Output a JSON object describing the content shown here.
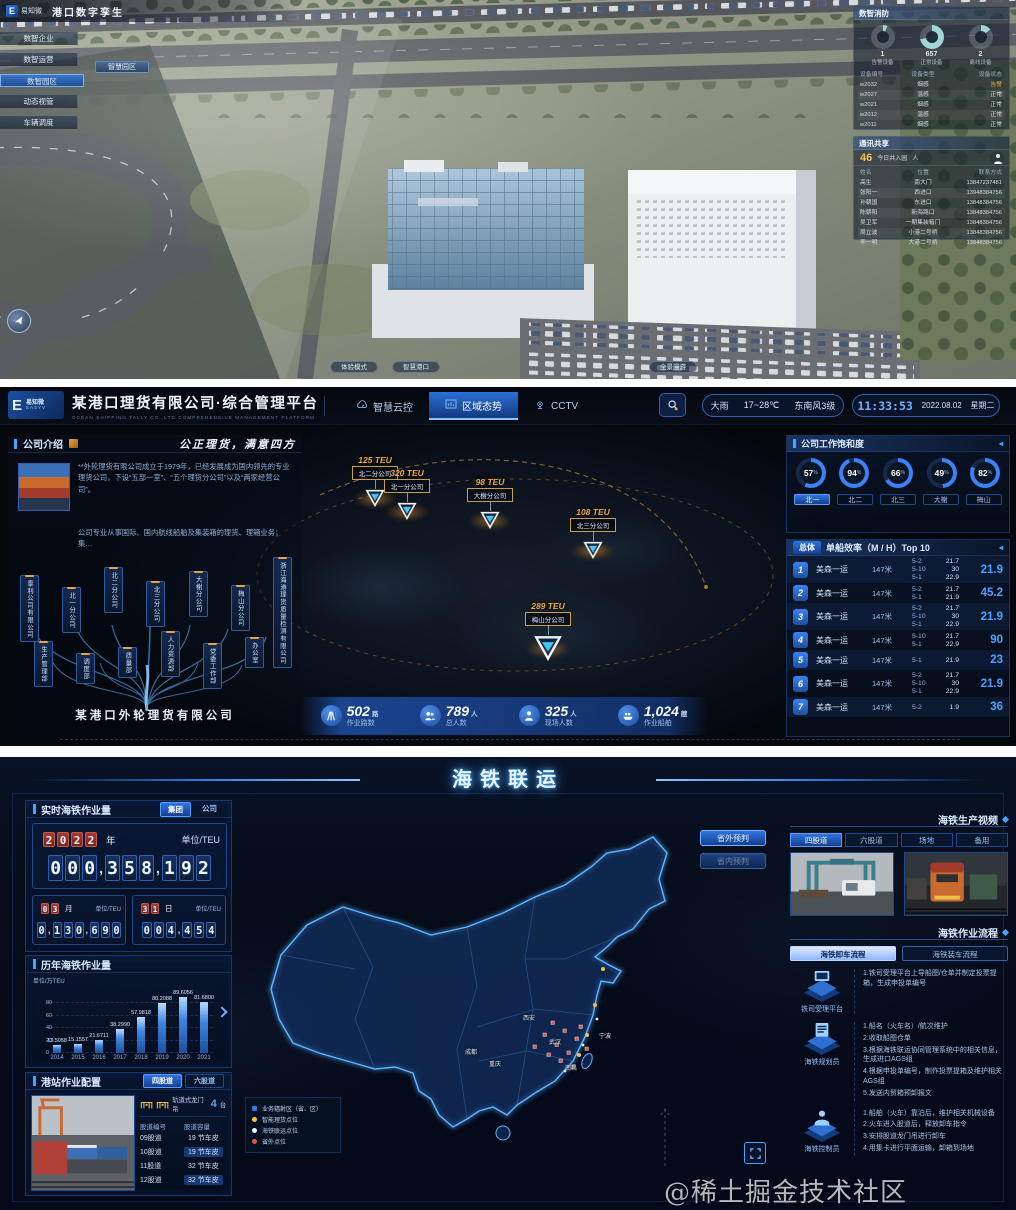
{
  "s1": {
    "logo": "易知微",
    "title": "港口数字孪生",
    "menu": [
      "数智企业",
      "数智运营",
      "数智园区",
      "动态视管",
      "车辆调度"
    ],
    "submenu": "智慧园区",
    "bottom_buttons": [
      "体验模式",
      "智慧港口",
      "全景漫游"
    ],
    "devices": {
      "title": "数智消防",
      "donuts": [
        {
          "value": "1",
          "label": "告警设备",
          "pct": 6
        },
        {
          "value": "657",
          "label": "正常设备",
          "pct": 72
        },
        {
          "value": "2",
          "label": "离线设备",
          "pct": 14
        }
      ],
      "headers": [
        "设备编号",
        "设备类型",
        "设备状态"
      ],
      "rows": [
        [
          "w2032",
          "烟感",
          "告警"
        ],
        [
          "w2027",
          "温感",
          "正常"
        ],
        [
          "w2021",
          "烟感",
          "正常"
        ],
        [
          "w2012",
          "温感",
          "正常"
        ],
        [
          "w2011",
          "烟感",
          "正常"
        ]
      ]
    },
    "contacts": {
      "title": "通讯共享",
      "today_value": "46",
      "today_label": "今日共入园",
      "today_unit": "人",
      "headers": [
        "姓名",
        "位置",
        "联系方式"
      ],
      "rows": [
        [
          "高生",
          "南大门",
          "13847237481"
        ],
        [
          "张阳一",
          "西进口",
          "13948384756"
        ],
        [
          "孙朝国",
          "东进口",
          "13848384756"
        ],
        [
          "陈朝阳",
          "新海路口",
          "13848384756"
        ],
        [
          "吴卫军",
          "一期集装箱门",
          "13848384756"
        ],
        [
          "周立波",
          "小港二号桥",
          "13848384756"
        ],
        [
          "李一明",
          "大港二号桥",
          "13848384756"
        ]
      ]
    }
  },
  "s2": {
    "logo_text": "易知微",
    "logo_sub": "EASYV",
    "title": "某港口理货有限公司·综合管理平台",
    "subtitle": "OCEAN SHIPPING TALLY CO.,LTD COMPREHENSIVE MANAGEMENT PLATFORM",
    "nav": [
      "智慧云控",
      "区域态势",
      "CCTV"
    ],
    "weather": {
      "cond": "大雨",
      "temp": "17~28℃",
      "wind": "东南风3级"
    },
    "clock": {
      "time": "11:33:53",
      "date": "2022.08.02",
      "week": "星期二"
    },
    "company": {
      "header": "公司介绍",
      "slogan": "公正理货，满意四方",
      "para1": "**外轮理货有限公司成立于1979年，已经发展成为国内领先的专业理货公司，下设“五部一室”、“五个理货分公司”以及“两家经营公司”。",
      "para2": "公司专业从事国际、国内航线船舶及集装箱的理货、理箱业务；集…",
      "org_top": [
        "泰利公司有限公司",
        "北一分公司",
        "北二分公司",
        "北三分公司",
        "大榭分公司",
        "梅山分公司",
        "浙江海港理货质量检测有限公司"
      ],
      "org_bottom": [
        "生产管理部",
        "调度部",
        "质量部",
        "人力资源部",
        "党委工作部",
        "办公室"
      ],
      "root": "某港口外轮理货有限公司"
    },
    "markers": [
      {
        "teu": "125 TEU",
        "name": "北二分公司"
      },
      {
        "teu": "320 TEU",
        "name": "北一分公司"
      },
      {
        "teu": "98 TEU",
        "name": "大榭分公司"
      },
      {
        "teu": "108 TEU",
        "name": "北三分公司"
      },
      {
        "teu": "289 TEU",
        "name": "梅山分公司"
      }
    ],
    "stats": [
      {
        "value": "502",
        "unit": "路",
        "label": "作业路数"
      },
      {
        "value": "789",
        "unit": "人",
        "label": "总人数"
      },
      {
        "value": "325",
        "unit": "人",
        "label": "现场人数"
      },
      {
        "value": "1,024",
        "unit": "艘",
        "label": "作业船舶"
      }
    ],
    "saturation": {
      "header": "公司工作饱和度",
      "gauges": [
        57,
        94,
        66,
        49,
        82
      ],
      "tabs": [
        "北一",
        "北二",
        "北三",
        "大榭",
        "梅山"
      ]
    },
    "top10": {
      "label": "总体",
      "header": "单船效率（M / H）Top 10",
      "rows": [
        {
          "rank": "1",
          "name": "美森一运",
          "len": "147米",
          "subs": [
            [
              "5-2",
              "21.7"
            ],
            [
              "5-10",
              "30"
            ],
            [
              "5-1",
              "22.9"
            ]
          ],
          "total": "21.9"
        },
        {
          "rank": "2",
          "name": "美森一运",
          "len": "147米",
          "subs": [
            [
              "5-2",
              "21.7"
            ],
            [
              "5-1",
              "21.9"
            ]
          ],
          "total": "45.2"
        },
        {
          "rank": "3",
          "name": "美森一运",
          "len": "147米",
          "subs": [
            [
              "5-2",
              "21.7"
            ],
            [
              "5-10",
              "30"
            ],
            [
              "5-1",
              "22.9"
            ]
          ],
          "total": "21.9"
        },
        {
          "rank": "4",
          "name": "美森一运",
          "len": "147米",
          "subs": [
            [
              "5-10",
              "21.7"
            ],
            [
              "5-1",
              "22.9"
            ]
          ],
          "total": "90"
        },
        {
          "rank": "5",
          "name": "美森一运",
          "len": "147米",
          "subs": [
            [
              "5-1",
              "21.9"
            ]
          ],
          "total": "23"
        },
        {
          "rank": "6",
          "name": "美森一运",
          "len": "147米",
          "subs": [
            [
              "5-2",
              "21.7"
            ],
            [
              "5-10",
              "30"
            ],
            [
              "5-1",
              "22.9"
            ]
          ],
          "total": "21.9"
        },
        {
          "rank": "7",
          "name": "美森一运",
          "len": "147米",
          "subs": [
            [
              "5-2",
              "1.9"
            ]
          ],
          "total": "36"
        }
      ]
    }
  },
  "s3": {
    "title": "海铁联运",
    "realtime": {
      "header": "实时海铁作业量",
      "toggles": [
        "集团",
        "公司"
      ],
      "year": "2022",
      "year_suffix": "年",
      "unit": "单位/TEU",
      "year_value": "000,358,192",
      "month": "03",
      "month_suffix": "月",
      "month_value": "0,130,690",
      "day": "31",
      "day_suffix": "日",
      "day_value": "004,454"
    },
    "station": {
      "header": "港站作业配置",
      "tabs": [
        "四股道",
        "六股道"
      ],
      "crane_label": "轨道式龙门吊",
      "crane_value": "4",
      "crane_unit": "台",
      "headers": [
        "股道编号",
        "股道容量"
      ],
      "rows": [
        [
          "09股道",
          "19 节车皮"
        ],
        [
          "10股道",
          "19 节车皮"
        ],
        [
          "11股道",
          "32 节车皮"
        ],
        [
          "12股道",
          "32 节车皮"
        ]
      ]
    },
    "map": {
      "buttons": [
        "省外预判",
        "省内预判"
      ],
      "legend": [
        {
          "color": "#2f7dd8",
          "label": "业务辐射区（省、区）"
        },
        {
          "color": "#f5c243",
          "label": "智能理货点位"
        },
        {
          "color": "#e8f4ff",
          "label": "海铁联运点位"
        },
        {
          "color": "#e2554d",
          "label": "省外点位"
        }
      ],
      "cities": [
        "西安",
        "成都",
        "重庆",
        "武汉",
        "南昌",
        "宁波"
      ]
    },
    "video": {
      "header": "海铁生产视频",
      "tabs": [
        "四股道",
        "六股道",
        "场地",
        "备用"
      ]
    },
    "process": {
      "header": "海铁作业流程",
      "tabs": [
        "海铁卸车流程",
        "海铁装车流程"
      ],
      "steps": [
        {
          "role": "铁司受理平台",
          "lines": [
            "1.铁司受理平台上导船图/仓单并制定投票提箱，生成申投单编号"
          ]
        },
        {
          "role": "海铁规划员",
          "lines": [
            "1.船名（火车名）/航次维护",
            "2.收取船图仓单",
            "3.根据海铁联运协同管理系统中的相关信息，生成进口AGS组",
            "4.根据申投单编号，制作投票提箱及维护相关AGS组",
            "5.发送内贸箱预卸报文"
          ]
        },
        {
          "role": "海铁控制员",
          "lines": [
            "1.船舶（火车）靠泊后，维护相关机械设备",
            "2.火车进入股道后，释放卸车指令",
            "3.安排股道龙门吊进行卸车",
            "4.用集卡进行平面运输，卸箱到场地"
          ]
        }
      ]
    }
  },
  "chart_data": {
    "type": "bar",
    "title": "历年海铁作业量",
    "ylabel": "单位/万TEU",
    "categories": [
      "2014",
      "2015",
      "2016",
      "2017",
      "2018",
      "2019",
      "2020",
      "2021"
    ],
    "values": [
      13.5058,
      15.1557,
      21.6711,
      38.299,
      57.9818,
      80.2088,
      89.6056,
      81.68
    ],
    "value_labels": [
      "13.5058",
      "15.1557",
      "21.6711",
      "38.2990",
      "57.9818",
      "80.2088",
      "89.6056",
      "81.6800"
    ],
    "ylim": [
      0,
      100
    ],
    "yticks": [
      0,
      20,
      40,
      60,
      80
    ],
    "grid": true,
    "legend_position": "none"
  },
  "watermark": "@稀土掘金技术社区"
}
